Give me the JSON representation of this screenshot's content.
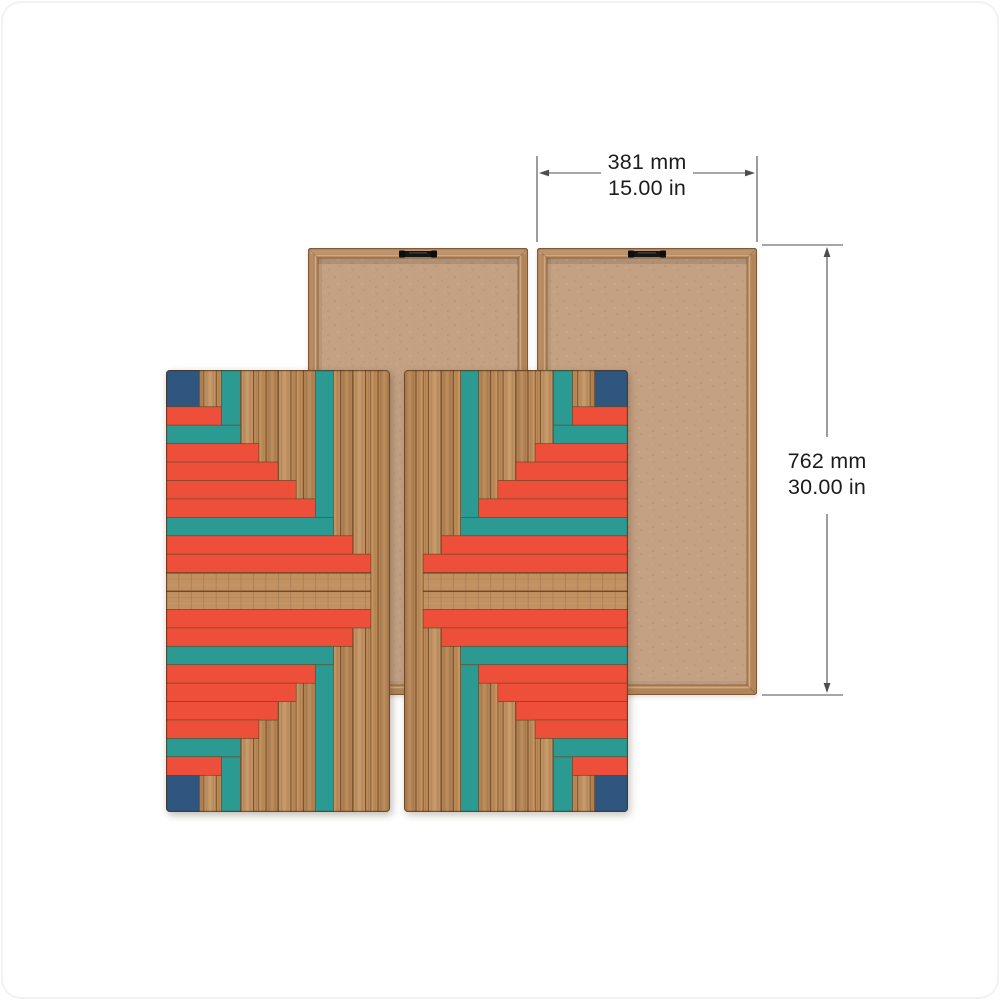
{
  "dimension_annotations": {
    "width": {
      "metric": "381 mm",
      "imperial": "15.00 in"
    },
    "height": {
      "metric": "762 mm",
      "imperial": "30.00 in"
    }
  },
  "palette": {
    "red": "#ee4f3a",
    "teal": "#2b9a93",
    "navy": "#2e567f",
    "wood": "#bb8a58",
    "wood_light": "#d0a26e",
    "wood_seam": "#6b4520",
    "wood_row": "#c29161",
    "back_frame": "#b28457",
    "back_frame_edge": "#7f5a36",
    "back_frame_light": "#d3b38f",
    "back_interior": "#c4a183",
    "back_speckle": "#9f7a58",
    "hanger_black": "#161616",
    "dim_line": "#4d4d4f",
    "dim_text": "#1c1c1c"
  },
  "front_panel_pattern": {
    "viewbox_width": 222,
    "viewbox_height": 442,
    "rows": [
      {
        "y": 0,
        "h": 36.8,
        "w": 33,
        "color": "navy"
      },
      {
        "y": 36.8,
        "h": 18.4,
        "w": 55,
        "color": "red"
      },
      {
        "y": 55.2,
        "h": 18.5,
        "w": 74,
        "color": "teal"
      },
      {
        "y": 73.7,
        "h": 18.4,
        "w": 92,
        "color": "red"
      },
      {
        "y": 92.1,
        "h": 18.4,
        "w": 111,
        "color": "red"
      },
      {
        "y": 110.5,
        "h": 18.4,
        "w": 129,
        "color": "red"
      },
      {
        "y": 128.9,
        "h": 18.5,
        "w": 148,
        "color": "red"
      },
      {
        "y": 147.4,
        "h": 18.4,
        "w": 166,
        "color": "teal"
      },
      {
        "y": 165.8,
        "h": 18.4,
        "w": 185,
        "color": "red"
      },
      {
        "y": 184.2,
        "h": 18.4,
        "w": 203,
        "color": "red"
      },
      {
        "y": 202.6,
        "h": 18.4,
        "w": 203,
        "color": "wood"
      },
      {
        "y": 221.0,
        "h": 18.5,
        "w": 203,
        "color": "wood"
      },
      {
        "y": 239.5,
        "h": 18.4,
        "w": 203,
        "color": "red"
      },
      {
        "y": 257.9,
        "h": 18.4,
        "w": 185,
        "color": "red"
      },
      {
        "y": 276.3,
        "h": 18.4,
        "w": 166,
        "color": "teal"
      },
      {
        "y": 294.7,
        "h": 18.5,
        "w": 148,
        "color": "red"
      },
      {
        "y": 313.2,
        "h": 18.4,
        "w": 129,
        "color": "red"
      },
      {
        "y": 331.6,
        "h": 18.4,
        "w": 111,
        "color": "red"
      },
      {
        "y": 350.0,
        "h": 18.4,
        "w": 92,
        "color": "red"
      },
      {
        "y": 368.4,
        "h": 18.4,
        "w": 74,
        "color": "teal"
      },
      {
        "y": 386.8,
        "h": 18.5,
        "w": 55,
        "color": "red"
      },
      {
        "y": 405.3,
        "h": 36.7,
        "w": 33,
        "color": "navy"
      }
    ],
    "columns": [
      {
        "x": 33,
        "w": 22,
        "y": 0,
        "h": 36.8,
        "color": "wood"
      },
      {
        "x": 55,
        "w": 19,
        "y": 0,
        "h": 55.2,
        "color": "teal"
      },
      {
        "x": 74,
        "w": 18,
        "y": 0,
        "h": 73.7,
        "color": "wood"
      },
      {
        "x": 92,
        "w": 19,
        "y": 0,
        "h": 92.1,
        "color": "wood"
      },
      {
        "x": 111,
        "w": 18,
        "y": 0,
        "h": 110.5,
        "color": "wood"
      },
      {
        "x": 129,
        "w": 19,
        "y": 0,
        "h": 128.9,
        "color": "wood"
      },
      {
        "x": 148,
        "w": 18,
        "y": 0,
        "h": 147.4,
        "color": "teal"
      },
      {
        "x": 166,
        "w": 19,
        "y": 0,
        "h": 165.8,
        "color": "wood"
      },
      {
        "x": 185,
        "w": 18,
        "y": 0,
        "h": 184.2,
        "color": "wood"
      },
      {
        "x": 203,
        "w": 19,
        "y": 0,
        "h": 442,
        "color": "wood"
      },
      {
        "x": 33,
        "w": 22,
        "y": 405.3,
        "h": 36.7,
        "color": "wood"
      },
      {
        "x": 55,
        "w": 19,
        "y": 386.8,
        "h": 55.2,
        "color": "teal"
      },
      {
        "x": 74,
        "w": 18,
        "y": 368.4,
        "h": 73.6,
        "color": "wood"
      },
      {
        "x": 92,
        "w": 19,
        "y": 350.0,
        "h": 92.0,
        "color": "wood"
      },
      {
        "x": 111,
        "w": 18,
        "y": 331.6,
        "h": 110.4,
        "color": "wood"
      },
      {
        "x": 129,
        "w": 19,
        "y": 313.2,
        "h": 128.8,
        "color": "wood"
      },
      {
        "x": 148,
        "w": 18,
        "y": 294.7,
        "h": 147.3,
        "color": "teal"
      },
      {
        "x": 166,
        "w": 19,
        "y": 276.3,
        "h": 165.7,
        "color": "wood"
      },
      {
        "x": 185,
        "w": 18,
        "y": 257.9,
        "h": 184.1,
        "color": "wood"
      }
    ]
  },
  "back_panel_pattern": {
    "viewbox_width": 220,
    "viewbox_height": 447,
    "frame_width": 10
  }
}
